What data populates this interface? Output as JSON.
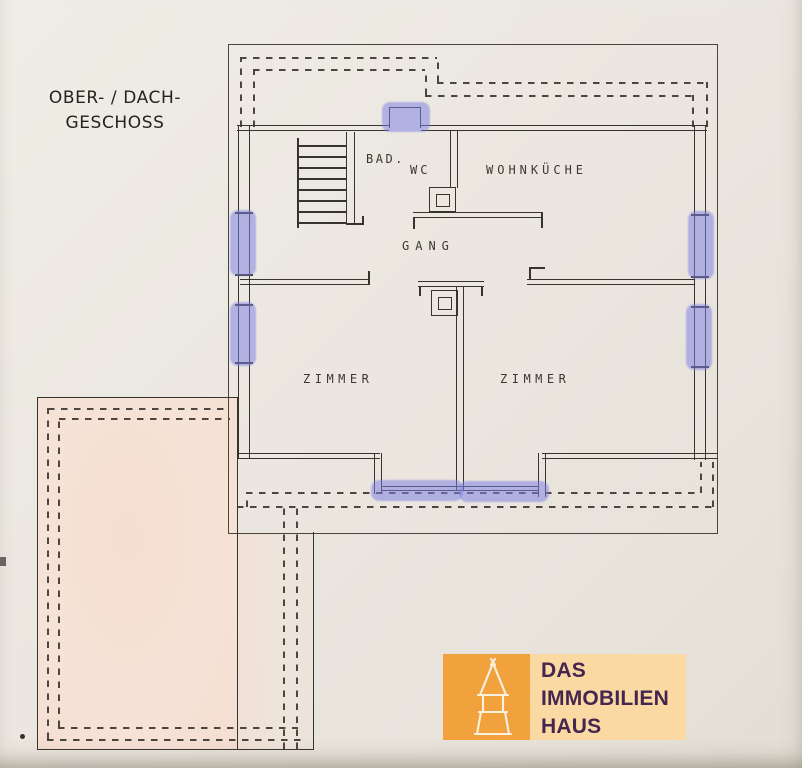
{
  "paper": {
    "background": "#ece8e1",
    "line_color": "#37342e",
    "dash_color": "#4b4740"
  },
  "title": {
    "line1": "OBER- / DACH-",
    "line2": "GESCHOSS"
  },
  "floor_plan": {
    "labels": {
      "bad": "BAD.",
      "wc": "WC",
      "wohnkueche": "WOHNKÜCHE",
      "gang": "GANG",
      "zimmer_left": "ZIMMER",
      "zimmer_right": "ZIMMER"
    },
    "window_highlight_color": "#7d80e3",
    "highlighted_windows": [
      "top-dormer-window",
      "left-wall-window-upper",
      "left-wall-window-lower",
      "right-wall-window-upper",
      "right-wall-window-lower",
      "south-window-left",
      "south-window-right"
    ],
    "terrace_fill": "#f6e3d7"
  },
  "logo": {
    "name": "DAS IMMOBILIEN HAUS",
    "line1": "DAS",
    "line2": "IMMOBILIEN",
    "line3": "HAUS",
    "icon": "tower-icon",
    "colors": {
      "square": "#f2a23c",
      "banner": "#fbd9a3",
      "text": "#45264e",
      "icon": "#faf0e0"
    }
  }
}
